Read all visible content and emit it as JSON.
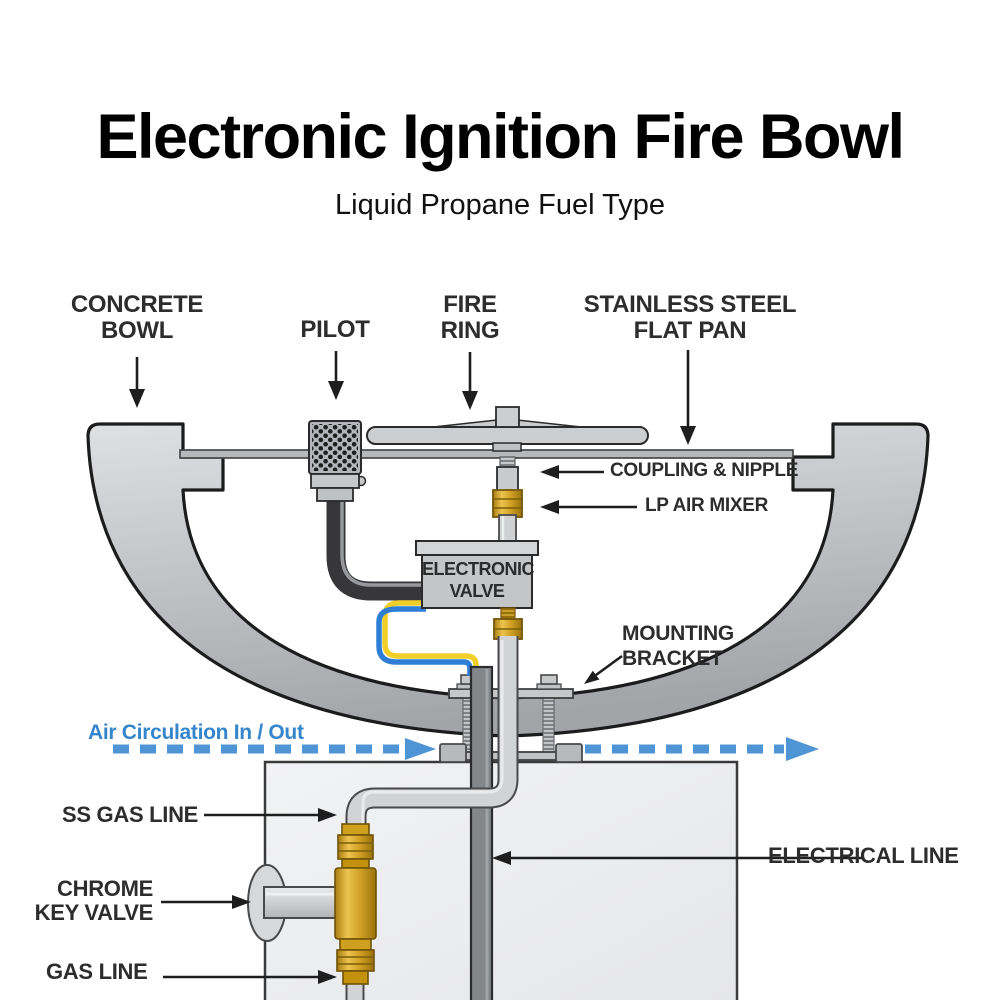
{
  "header": {
    "title": "Electronic Ignition Fire Bowl",
    "subtitle": "Liquid Propane Fuel Type"
  },
  "diagram": {
    "callouts": {
      "concrete_bowl": {
        "line1": "CONCRETE",
        "line2": "BOWL"
      },
      "pilot": {
        "label": "PILOT"
      },
      "fire_ring": {
        "line1": "FIRE",
        "line2": "RING"
      },
      "flat_pan": {
        "line1": "STAINLESS STEEL",
        "line2": "FLAT PAN"
      },
      "coupling_nipple": {
        "label": "COUPLING & NIPPLE"
      },
      "lp_air_mixer": {
        "label": "LP AIR MIXER"
      },
      "electronic_valve": {
        "line1": "ELECTRONIC",
        "line2": "VALVE"
      },
      "mounting_bracket": {
        "line1": "MOUNTING",
        "line2": "BRACKET"
      },
      "air_circulation": {
        "label": "Air Circulation In / Out"
      },
      "ss_gas_line": {
        "label": "SS GAS LINE"
      },
      "chrome_key_valve": {
        "line1": "CHROME",
        "line2": "KEY VALVE"
      },
      "gas_line": {
        "label": "GAS LINE"
      },
      "electrical_line": {
        "label": "ELECTRICAL  LINE"
      }
    },
    "colors": {
      "label_ink": "#2d2d2d",
      "accent_blue_text": "#3585cd",
      "accent_blue_dash": "#4f94d4",
      "brass": "#d2a226",
      "wire_blue": "#2e7ed5",
      "wire_yellow": "#f2cf28",
      "metal_light": "#d0d1d3",
      "metal_dark": "#85888b"
    }
  }
}
